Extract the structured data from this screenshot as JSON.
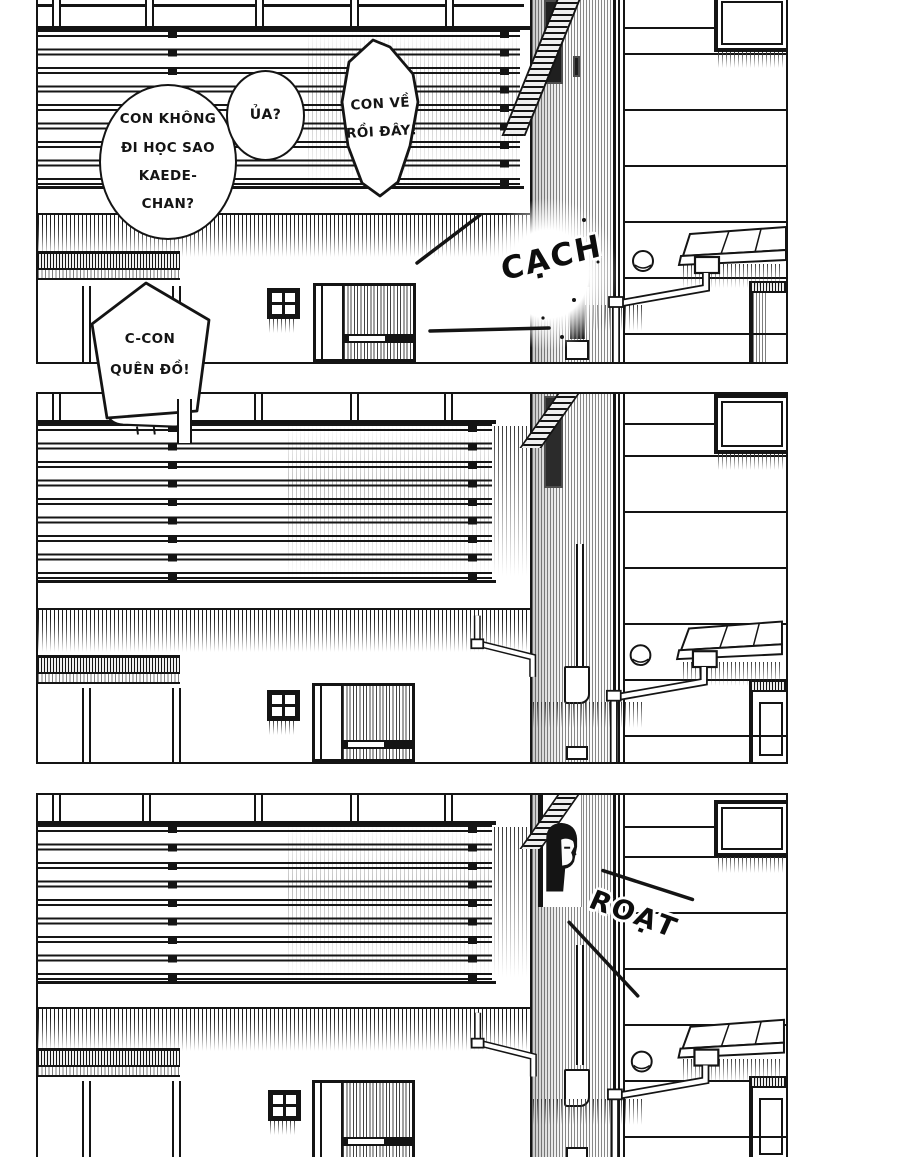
{
  "colors": {
    "ink": "#141414",
    "paper": "#ffffff"
  },
  "panel1": {
    "bubble_question": {
      "lines": [
        "CON KHÔNG",
        "ĐI HỌC SAO",
        "KAEDE-",
        "CHAN?"
      ]
    },
    "bubble_ua": {
      "text": "ỦA?"
    },
    "bubble_announce": {
      "lines": [
        "CON VỀ",
        "RỒI ĐÂY!"
      ]
    },
    "bubble_forgot": {
      "lines": [
        "C-CON",
        "QUÊN ĐỒ!"
      ]
    },
    "sfx_door": {
      "text": "CẠCH"
    }
  },
  "panel3": {
    "sfx_slide": {
      "text": "ROẠT"
    }
  }
}
